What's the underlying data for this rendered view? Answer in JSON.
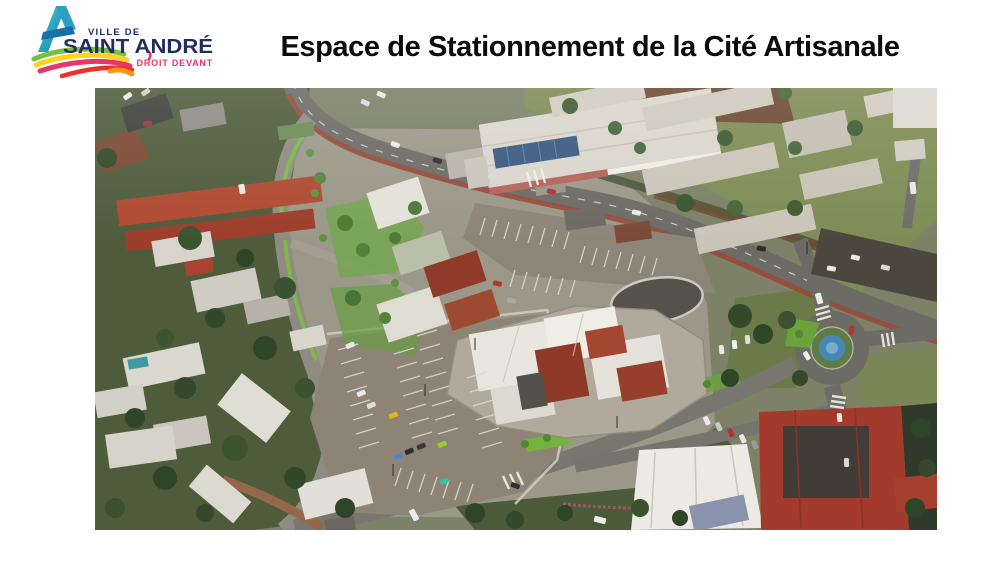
{
  "header": {
    "title": "Espace de Stationnement de la Cité Artisanale"
  },
  "logo": {
    "prefix": "VILLE DE",
    "name": "SAINT ANDRÉ",
    "tagline": "DROIT DEVANT",
    "colors": {
      "navy": "#232e5f",
      "teal": "#2aa9c6",
      "green": "#76c043",
      "yellow": "#ffd21e",
      "magenta": "#e8336d",
      "red": "#ee3124",
      "orange": "#f7941d"
    }
  },
  "aerial_view": {
    "description": "Aerial 3D rendering of the planned parking area of the Cité Artisanale in Saint-André: a landscaped car park with marked bays and coloured cars, artisan workshops with red corrugated roofs, surrounding residential streets with red and white roofs, a school campus with long grey-roofed buildings, a main road with a red cycle lane, and a roundabout with a blue fountain.",
    "features": [
      "residential district with red and white roofs (west)",
      "main road with red cycle lane (north)",
      "school campus with long grey-roofed buildings (north-east)",
      "new landscaped parking lot with marked bays and coloured cars (centre)",
      "artisan workshops with red corrugated roofs (centre-east)",
      "roundabout with blue fountain (east)",
      "commercial buildings with red roofs (south-east)"
    ],
    "palette": {
      "asphalt": "#6c6b66",
      "parking_surface": "#8d8476",
      "lawn": "#7e8c55",
      "landscaping_green": "#7cbd42",
      "tree_green": "#3c5230",
      "red_roof": "#a23b2c",
      "white_roof": "#e7e4dd",
      "fountain_blue": "#4888b8",
      "cycle_lane_red": "#98493a"
    }
  }
}
